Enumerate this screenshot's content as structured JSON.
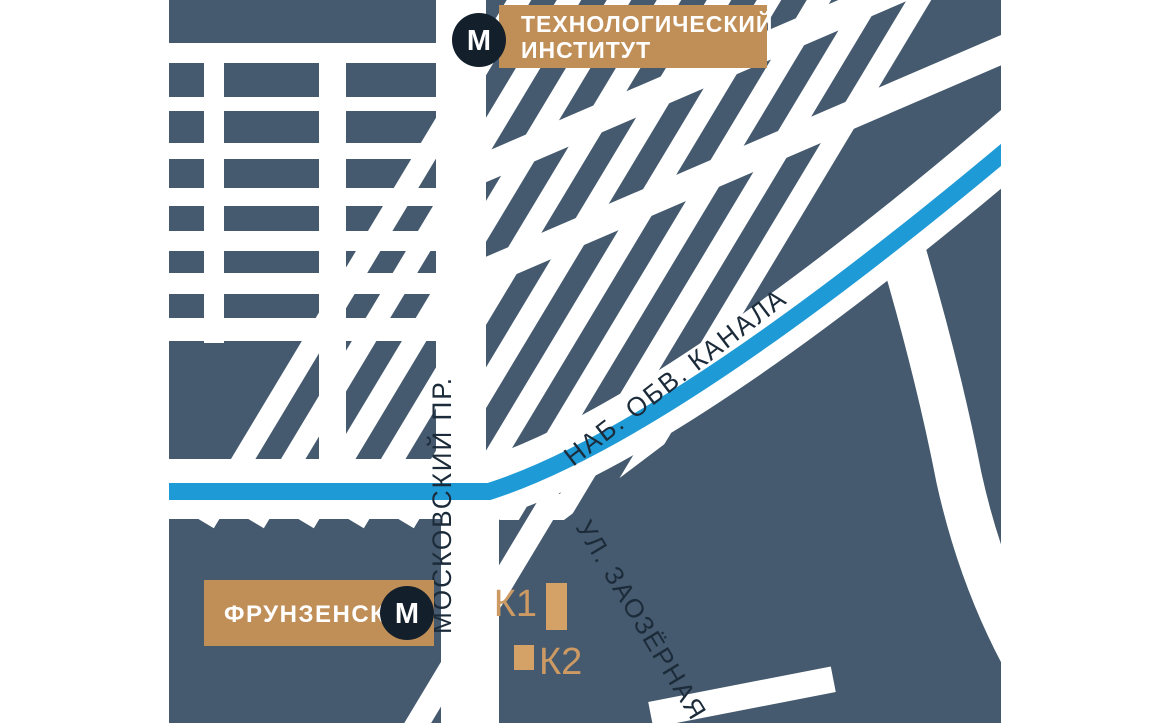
{
  "map": {
    "colors": {
      "page_background": "#FFFFFF",
      "land": "#455A6E",
      "road": "#FFFFFF",
      "canal": "#1E9AD6",
      "accent_tan": "#C08F58",
      "metro_circle": "#131F2B",
      "station_text": "#FFFFFF",
      "road_label": "#1C2B3A",
      "building": "#D4A167",
      "building_label": "#CD9A63"
    },
    "stations": {
      "technologichesky": {
        "symbol": "М",
        "line1": "ТЕХНОЛОГИЧЕСКИЙ",
        "line2": "ИНСТИТУТ"
      },
      "frunzenskaya": {
        "symbol": "М",
        "name": "ФРУНЗЕНСКАЯ"
      }
    },
    "streets": {
      "moskovsky": "МОСКОВСКИЙ ПР.",
      "canal": "НАБ. ОБВ. КАНАЛА",
      "zaozernaya": "УЛ. ЗАОЗЁРНАЯ"
    },
    "buildings": {
      "k1": "К1",
      "k2": "К2"
    }
  }
}
